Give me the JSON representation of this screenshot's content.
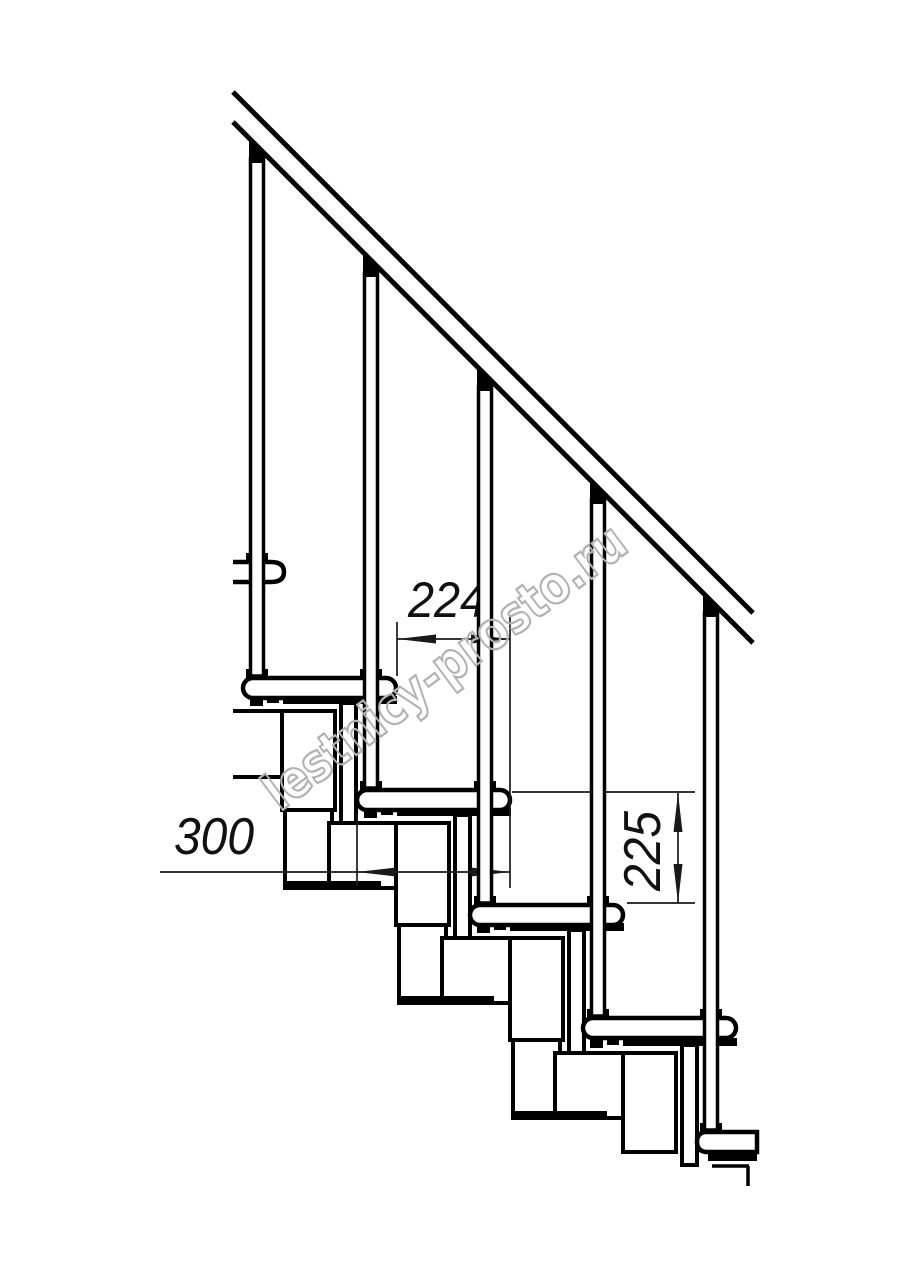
{
  "dimensions": {
    "run": "224",
    "tread_depth": "300",
    "rise": "225"
  },
  "watermark": {
    "text": "lestnicy-prosto.ru"
  },
  "colors": {
    "background": "#ffffff",
    "structure_line": "#000000",
    "dimension_line": "#1a1a1a",
    "watermark": "#b2b2b2"
  },
  "counts": {
    "balusters": 5,
    "treads_visible": 6
  }
}
